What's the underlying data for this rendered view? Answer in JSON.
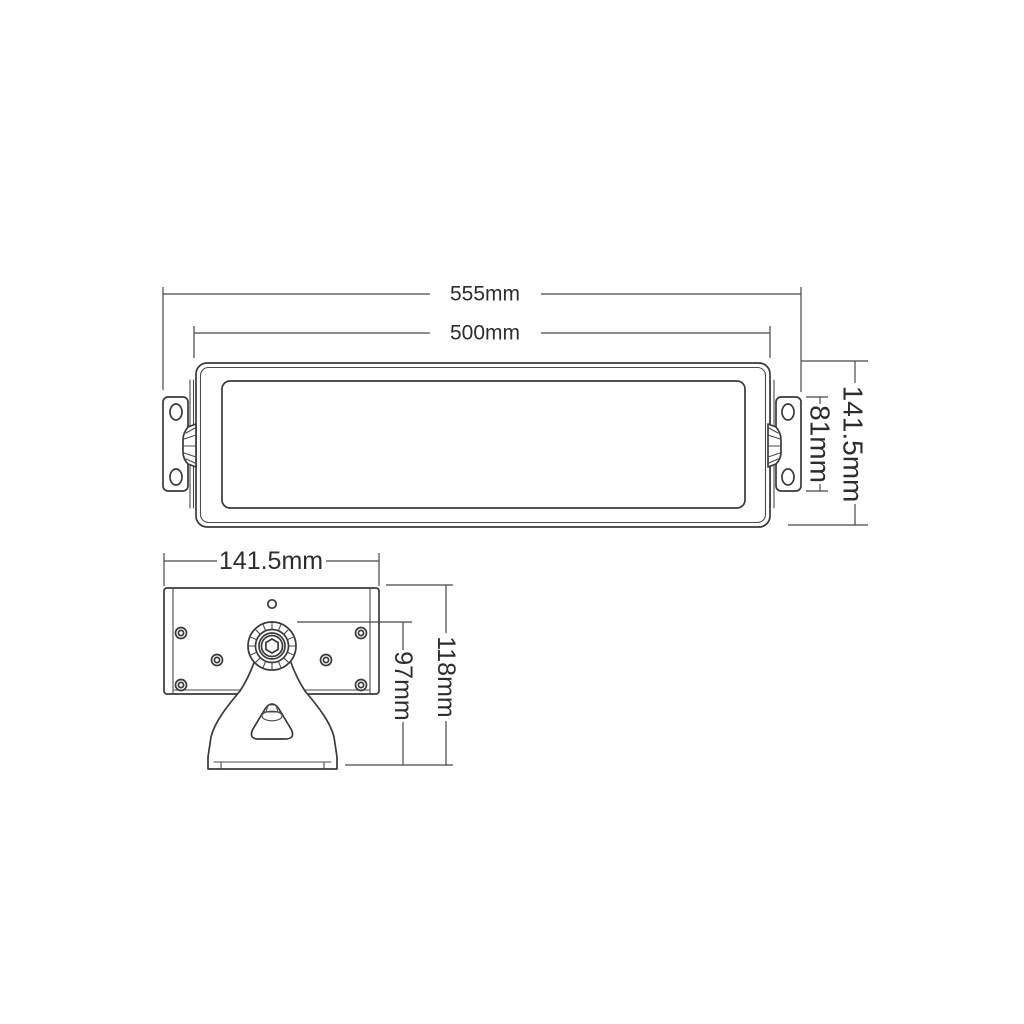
{
  "colors": {
    "background": "#ffffff",
    "object_line": "#3a3a3a",
    "dimension_line": "#474747",
    "text": "#2d2d2d"
  },
  "front_view": {
    "dim_overall_width": "555mm",
    "dim_inner_width": "500mm",
    "dim_bracket_height": "81mm",
    "dim_overall_height": "141.5mm"
  },
  "side_view": {
    "dim_body_width": "141.5mm",
    "dim_pivot_to_base_height": "97mm",
    "dim_overall_height": "118mm"
  }
}
